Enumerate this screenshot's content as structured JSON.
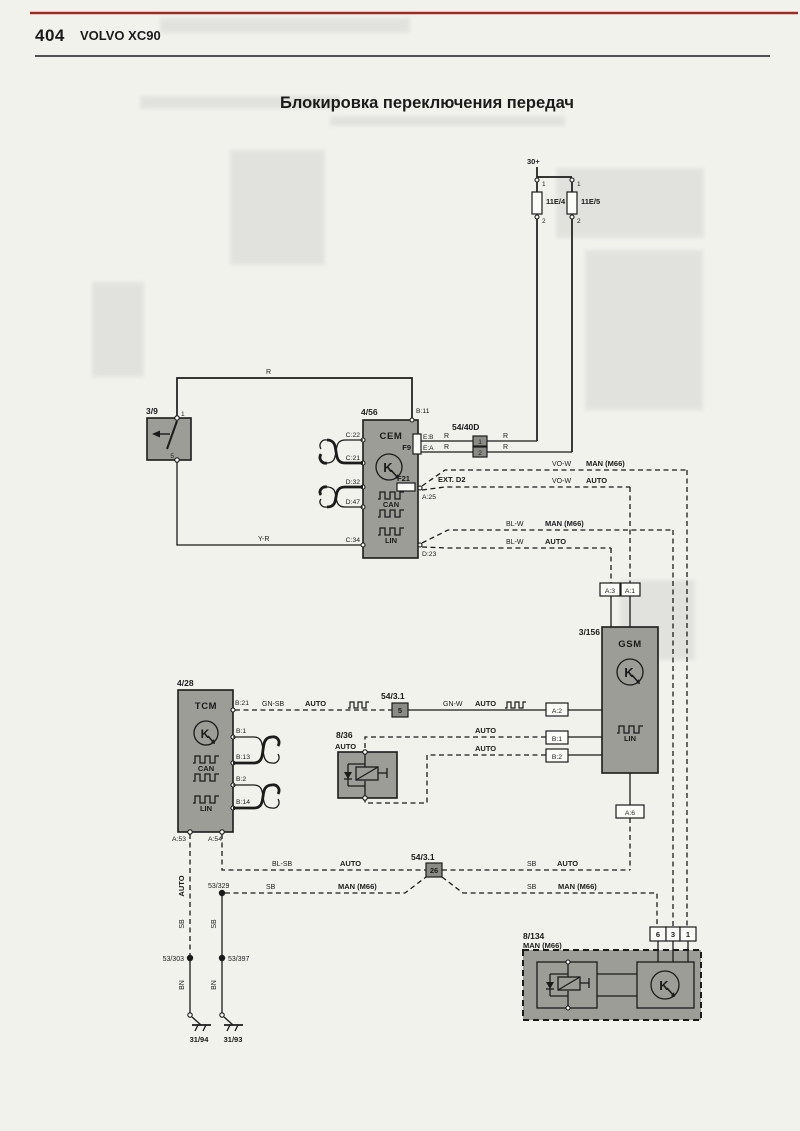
{
  "page": {
    "number": "404",
    "brand": "VOLVO XC90",
    "title": "Блокировка переключения передач"
  },
  "icons": {
    "module_letter": "K"
  },
  "colors": {
    "header_rule": "#9e2b25",
    "component_fill": "#9d9d97",
    "paper": "#f2f2ed",
    "line": "#1b1b1b"
  },
  "power": {
    "bus": "30+",
    "fuse1": "11E/4",
    "fuse2": "11E/5",
    "p1": "1",
    "p2": "2"
  },
  "sw39": {
    "id": "3/9",
    "p1": "1",
    "p5": "5"
  },
  "cem": {
    "id": "4/56",
    "name": "CEM",
    "b11": "B:11",
    "f9": "F9",
    "eb": "E:B",
    "ea": "E:A",
    "f21": "F21",
    "a25": "A:25",
    "ext": "EXT. D2",
    "d23": "D:23",
    "c22": "C:22",
    "c21": "C:21",
    "d32": "D:32",
    "d47": "D:47",
    "c34": "C:34",
    "can": "CAN",
    "lin": "LIN"
  },
  "c5440d": {
    "id": "54/40D",
    "p1": "1",
    "p2": "2"
  },
  "gsm": {
    "id": "3/156",
    "name": "GSM",
    "a3": "A:3",
    "a1": "A:1",
    "a2": "A:2",
    "b1": "B:1",
    "b2": "B:2",
    "a6": "A:6",
    "lin": "LIN"
  },
  "tcm": {
    "id": "4/28",
    "name": "TCM",
    "b21": "B:21",
    "b1": "B:1",
    "b13": "B:13",
    "b2": "B:2",
    "b14": "B:14",
    "a53": "A:53",
    "a54": "A:54",
    "can": "CAN",
    "lin": "LIN"
  },
  "sol836": {
    "id": "8/36",
    "variant": "AUTO"
  },
  "c5431a": {
    "id": "54/3.1",
    "pin": "5"
  },
  "c5431b": {
    "id": "54/3.1",
    "pin": "26"
  },
  "m8134": {
    "id": "8/134",
    "variant": "MAN (M66)",
    "p6": "6",
    "p3": "3",
    "p1": "1"
  },
  "splices": {
    "s303": "53/303",
    "s329": "53/329",
    "s397": "53/397"
  },
  "grounds": {
    "g94": "31/94",
    "g93": "31/93"
  },
  "w": {
    "r": "R",
    "yr": "Y-R",
    "vow": "VO-W",
    "blw": "BL-W",
    "gnsb": "GN-SB",
    "gnw": "GN-W",
    "blsb": "BL-SB",
    "sb": "SB",
    "bn": "BN",
    "auto": "AUTO",
    "man": "MAN (M66)"
  }
}
